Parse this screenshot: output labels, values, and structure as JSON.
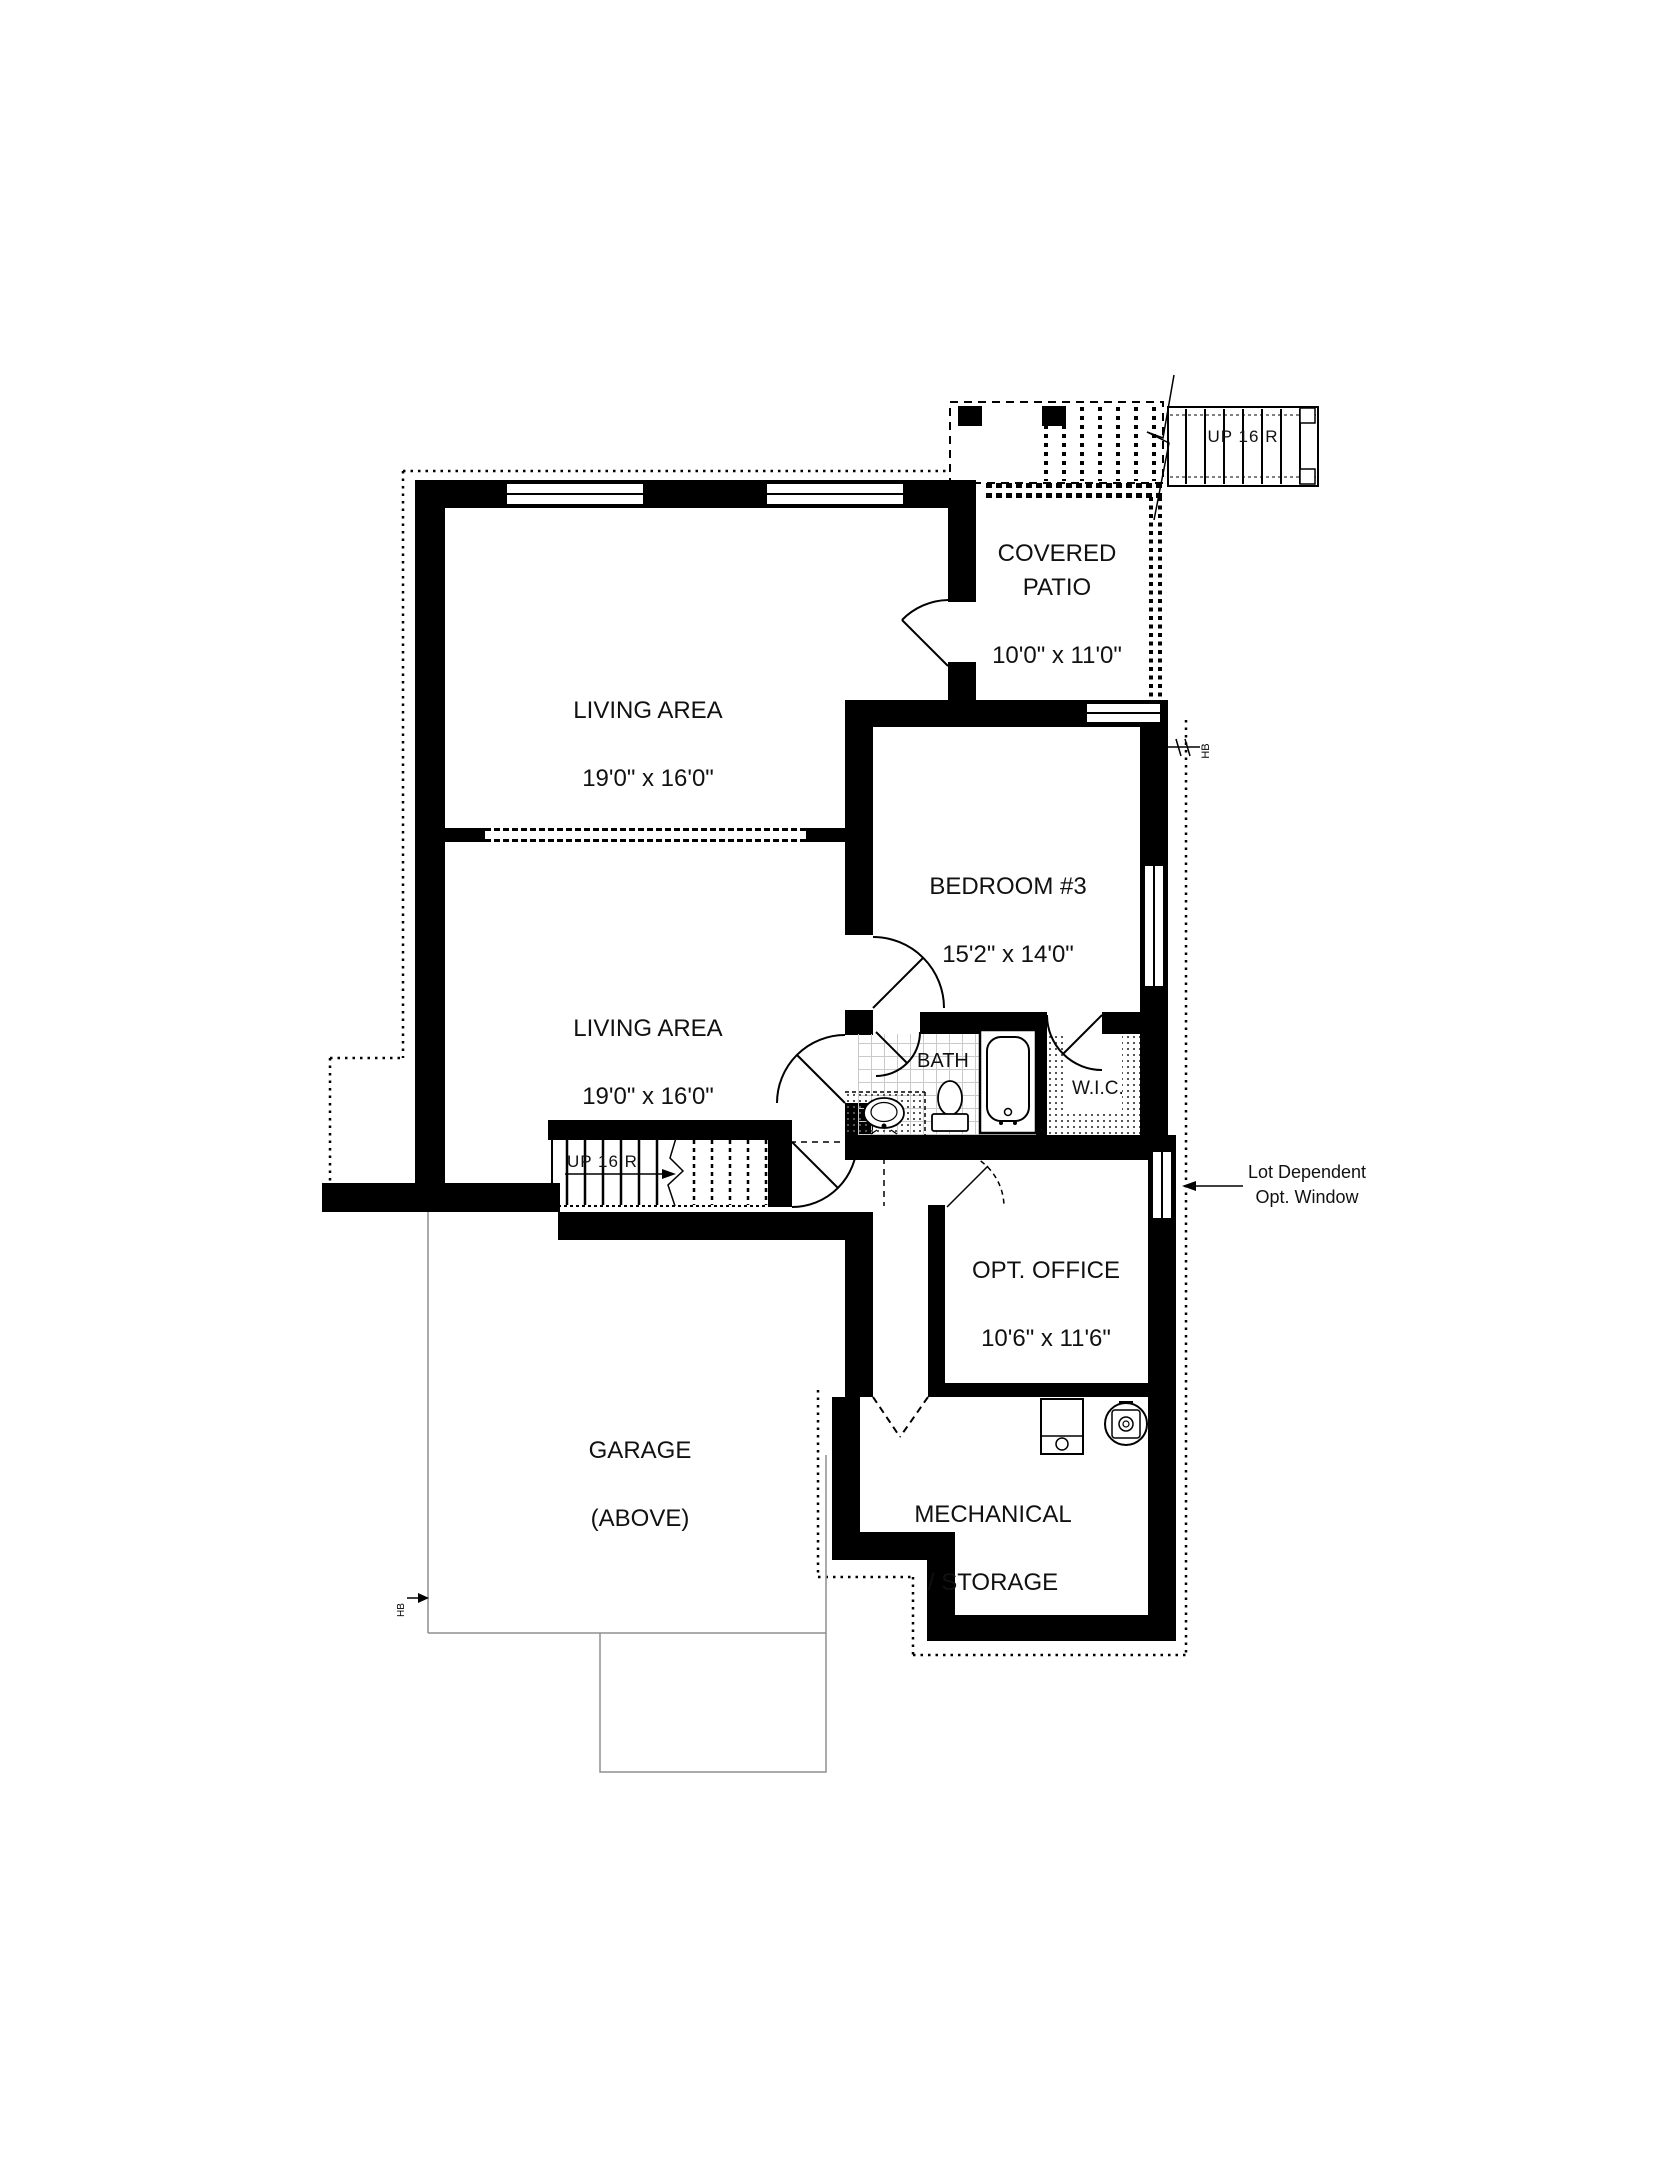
{
  "plan": {
    "rooms": {
      "covered_patio": {
        "name": "COVERED PATIO",
        "dims": "10'0\" x 11'0\""
      },
      "living_area_1": {
        "name": "LIVING AREA",
        "dims": "19'0\" x 16'0\""
      },
      "bedroom_3": {
        "name": "BEDROOM #3",
        "dims": "15'2\" x 14'0\""
      },
      "living_area_2": {
        "name": "LIVING AREA",
        "dims": "19'0\" x 16'0\""
      },
      "bath": {
        "name": "BATH"
      },
      "wic": {
        "name": "W.I.C."
      },
      "opt_office": {
        "name": "OPT. OFFICE",
        "dims": "10'6\" x 11'6\""
      },
      "garage": {
        "name": "GARAGE",
        "subtitle": "(ABOVE)"
      },
      "mechanical": {
        "name": "MECHANICAL",
        "subtitle": "/ STORAGE"
      }
    },
    "stairs": {
      "interior": {
        "label": "UP 16 R"
      },
      "exterior": {
        "label": "UP 16 R"
      }
    },
    "annotations": {
      "opt_window": {
        "line1": "Lot Dependent",
        "line2": "Opt. Window"
      },
      "hose_bib_right": "HB",
      "hose_bib_left": "HB"
    }
  }
}
